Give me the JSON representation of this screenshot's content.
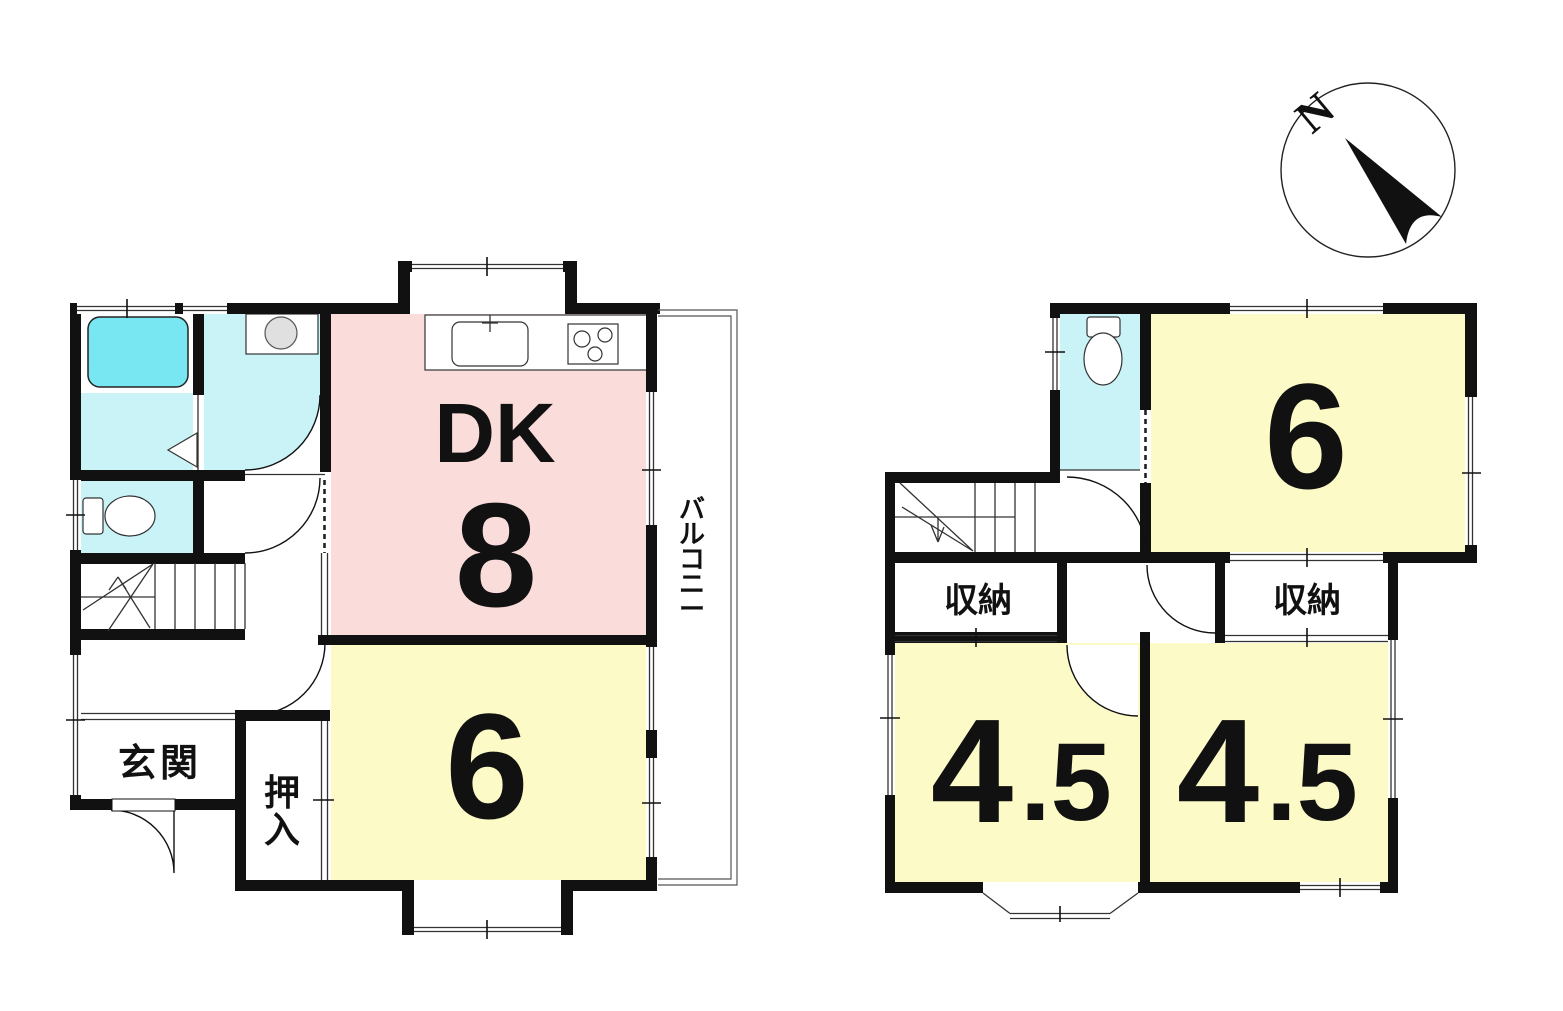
{
  "compass": {
    "north_label": "N"
  },
  "floor1": {
    "dk_label": "DK",
    "dk_size": "8",
    "room6_size": "6",
    "genkan_label": "玄関",
    "oshiire_chars": [
      "押",
      "入"
    ],
    "balcony_chars": [
      "バ",
      "ル",
      "コ",
      "ニ",
      "ー"
    ]
  },
  "floor2": {
    "room6_size": "6",
    "room45_left_main": "4",
    "room45_left_frac": ".5",
    "room45_right_main": "4",
    "room45_right_frac": ".5",
    "storage_left_label": "収納",
    "storage_right_label": "収納"
  },
  "colors": {
    "room_pink": "#fadcdb",
    "room_yellow": "#fcfac6",
    "wet_cyan": "#c9f3f7",
    "tub_cyan": "#79e7f1",
    "sink_gray": "#e0e0e0"
  }
}
